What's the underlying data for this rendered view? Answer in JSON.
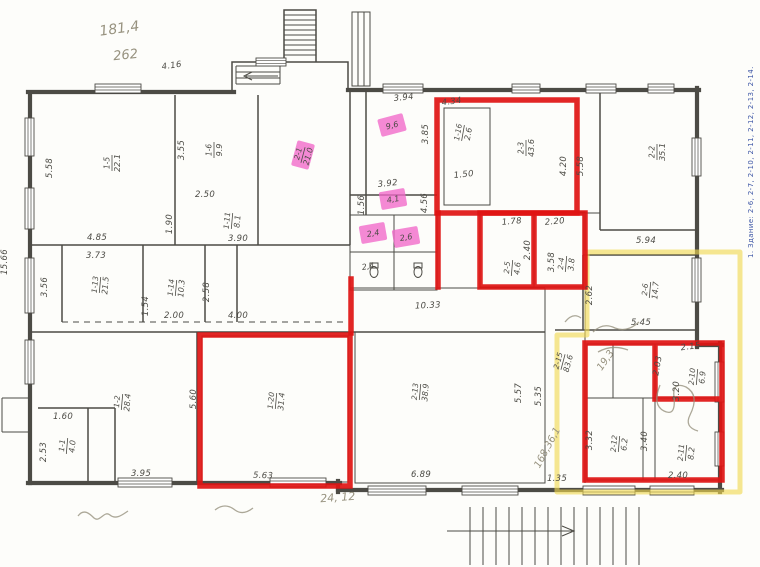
{
  "colors": {
    "ink": "#4c4b45",
    "marker_red": "#df1412",
    "highlight_yellow": "#f0d94f",
    "highlight_pink": "#f168c9",
    "pencil": "#97927f",
    "blue_note": "#3c55a5",
    "paper": "#fdfdfa"
  },
  "side_note": "1. Здание: 2-6, 2-7, 2-10, 2-11, 2-12, 2-13, 2-14.",
  "plan": {
    "dim_labels": [
      {
        "t": "4.16",
        "x": 172,
        "y": 68,
        "r": -8
      },
      {
        "t": "3.94",
        "x": 404,
        "y": 100,
        "r": -6
      },
      {
        "t": "4.34",
        "x": 452,
        "y": 104,
        "r": -8
      },
      {
        "t": "5.58",
        "x": 52,
        "y": 168,
        "r": -90
      },
      {
        "t": "3.55",
        "x": 184,
        "y": 150,
        "r": -90
      },
      {
        "t": "5.58",
        "x": 583,
        "y": 166,
        "r": -90
      },
      {
        "t": "4.20",
        "x": 566,
        "y": 166,
        "r": -90
      },
      {
        "t": "3.85",
        "x": 428,
        "y": 134,
        "r": -90
      },
      {
        "t": "1.50",
        "x": 464,
        "y": 177,
        "r": -6
      },
      {
        "t": "4.85",
        "x": 97,
        "y": 240,
        "r": 0
      },
      {
        "t": "2.50",
        "x": 205,
        "y": 197,
        "r": 0
      },
      {
        "t": "1.90",
        "x": 172,
        "y": 224,
        "r": -90
      },
      {
        "t": "3.90",
        "x": 238,
        "y": 241,
        "r": 0
      },
      {
        "t": "3.73",
        "x": 96,
        "y": 258,
        "r": 0
      },
      {
        "t": "3.56",
        "x": 47,
        "y": 287,
        "r": -90
      },
      {
        "t": "15.66",
        "x": 7,
        "y": 262,
        "r": -90
      },
      {
        "t": "1.54",
        "x": 148,
        "y": 306,
        "r": -90
      },
      {
        "t": "2.00",
        "x": 174,
        "y": 318,
        "r": 0
      },
      {
        "t": "2.58",
        "x": 209,
        "y": 292,
        "r": -90
      },
      {
        "t": "4.00",
        "x": 238,
        "y": 318,
        "r": 0
      },
      {
        "t": "3.92",
        "x": 388,
        "y": 186,
        "r": -6
      },
      {
        "t": "1.56",
        "x": 364,
        "y": 205,
        "r": -90
      },
      {
        "t": "4.56",
        "x": 427,
        "y": 203,
        "r": -90
      },
      {
        "t": "10.33",
        "x": 428,
        "y": 308,
        "r": -3
      },
      {
        "t": "1.78",
        "x": 512,
        "y": 224,
        "r": -5
      },
      {
        "t": "2.20",
        "x": 555,
        "y": 224,
        "r": -5
      },
      {
        "t": "2.40",
        "x": 530,
        "y": 250,
        "r": -90
      },
      {
        "t": "3.58",
        "x": 554,
        "y": 262,
        "r": -90
      },
      {
        "t": "2.62",
        "x": 592,
        "y": 295,
        "r": -90
      },
      {
        "t": "5.45",
        "x": 641,
        "y": 325,
        "r": 0
      },
      {
        "t": "5.94",
        "x": 646,
        "y": 243,
        "r": 0
      },
      {
        "t": "5.60",
        "x": 196,
        "y": 399,
        "r": -90
      },
      {
        "t": "1.60",
        "x": 63,
        "y": 419,
        "r": 0
      },
      {
        "t": "2.53",
        "x": 46,
        "y": 452,
        "r": -90
      },
      {
        "t": "3.95",
        "x": 141,
        "y": 476,
        "r": 0
      },
      {
        "t": "5.63",
        "x": 263,
        "y": 478,
        "r": 2
      },
      {
        "t": "6.89",
        "x": 421,
        "y": 477,
        "r": 0
      },
      {
        "t": "5.57",
        "x": 521,
        "y": 393,
        "r": -90
      },
      {
        "t": "5.35",
        "x": 541,
        "y": 396,
        "r": -90
      },
      {
        "t": "1.35",
        "x": 557,
        "y": 481,
        "r": 0
      },
      {
        "t": "2.15",
        "x": 691,
        "y": 349,
        "r": -8
      },
      {
        "t": "2.03",
        "x": 660,
        "y": 366,
        "r": -80
      },
      {
        "t": "3.20",
        "x": 679,
        "y": 391,
        "r": -90
      },
      {
        "t": "3.32",
        "x": 592,
        "y": 440,
        "r": -90
      },
      {
        "t": "3.40",
        "x": 647,
        "y": 441,
        "r": -90
      },
      {
        "t": "2.40",
        "x": 678,
        "y": 478,
        "r": 0
      }
    ],
    "room_labels": [
      {
        "num": "1-5",
        "area": "22.1",
        "x": 112,
        "y": 163,
        "r": -90,
        "hl": false
      },
      {
        "num": "1-6",
        "area": "9.9",
        "x": 214,
        "y": 150,
        "r": -90,
        "hl": false
      },
      {
        "num": "2-1",
        "area": "21.0",
        "x": 303,
        "y": 155,
        "r": -75,
        "hl": true
      },
      {
        "num": "",
        "area": "9,6",
        "x": 392,
        "y": 125,
        "r": -15,
        "hl": true
      },
      {
        "num": "2-3",
        "area": "43.6",
        "x": 526,
        "y": 148,
        "r": -90,
        "hl": false
      },
      {
        "num": "1-16",
        "area": "2.6",
        "x": 463,
        "y": 133,
        "r": -80,
        "hl": false
      },
      {
        "num": "2-2",
        "area": "35.1",
        "x": 657,
        "y": 152,
        "r": -90,
        "hl": false
      },
      {
        "num": "1-11",
        "area": "8.1",
        "x": 232,
        "y": 221,
        "r": -85,
        "hl": false
      },
      {
        "num": "1-13",
        "area": "21.5",
        "x": 100,
        "y": 285,
        "r": -85,
        "hl": false
      },
      {
        "num": "1-14",
        "area": "10.3",
        "x": 176,
        "y": 288,
        "r": -85,
        "hl": false
      },
      {
        "num": "",
        "area": "4,1",
        "x": 393,
        "y": 199,
        "r": -10,
        "hl": true
      },
      {
        "num": "",
        "area": "2,4",
        "x": 373,
        "y": 233,
        "r": -10,
        "hl": true
      },
      {
        "num": "",
        "area": "2,6",
        "x": 406,
        "y": 237,
        "r": -10,
        "hl": true
      },
      {
        "num": "",
        "area": "2,4",
        "x": 368,
        "y": 266,
        "r": -10,
        "hl": false
      },
      {
        "num": "2-5",
        "area": "4.6",
        "x": 512,
        "y": 268,
        "r": -85,
        "hl": false
      },
      {
        "num": "2-4",
        "area": "3.8",
        "x": 566,
        "y": 264,
        "r": -85,
        "hl": false
      },
      {
        "num": "2-6",
        "area": "14.7",
        "x": 650,
        "y": 290,
        "r": -85,
        "hl": false
      },
      {
        "num": "2-15",
        "area": "83.6",
        "x": 563,
        "y": 362,
        "r": -75,
        "hl": false
      },
      {
        "num": "1-2",
        "area": "28.4",
        "x": 122,
        "y": 402,
        "r": -85,
        "hl": false
      },
      {
        "num": "1-1",
        "area": "4.0",
        "x": 67,
        "y": 446,
        "r": -85,
        "hl": false
      },
      {
        "num": "1-20",
        "area": "31.4",
        "x": 276,
        "y": 401,
        "r": -85,
        "hl": false
      },
      {
        "num": "2-13",
        "area": "38.9",
        "x": 420,
        "y": 392,
        "r": -85,
        "hl": false
      },
      {
        "num": "2-10",
        "area": "6.9",
        "x": 697,
        "y": 377,
        "r": -85,
        "hl": false
      },
      {
        "num": "2-12",
        "area": "6.2",
        "x": 619,
        "y": 444,
        "r": -85,
        "hl": false
      },
      {
        "num": "2-11",
        "area": "8.2",
        "x": 686,
        "y": 453,
        "r": -85,
        "hl": false
      }
    ],
    "pencil_notes": [
      {
        "t": "181,4",
        "x": 120,
        "y": 33,
        "r": -8,
        "s": 14
      },
      {
        "t": "262",
        "x": 126,
        "y": 59,
        "r": -6,
        "s": 13
      },
      {
        "t": "24, 12",
        "x": 338,
        "y": 501,
        "r": -4,
        "s": 11
      },
      {
        "t": "168,36,1",
        "x": 550,
        "y": 449,
        "r": -62,
        "s": 10
      },
      {
        "t": "19,3",
        "x": 608,
        "y": 362,
        "r": -55,
        "s": 10
      }
    ]
  }
}
